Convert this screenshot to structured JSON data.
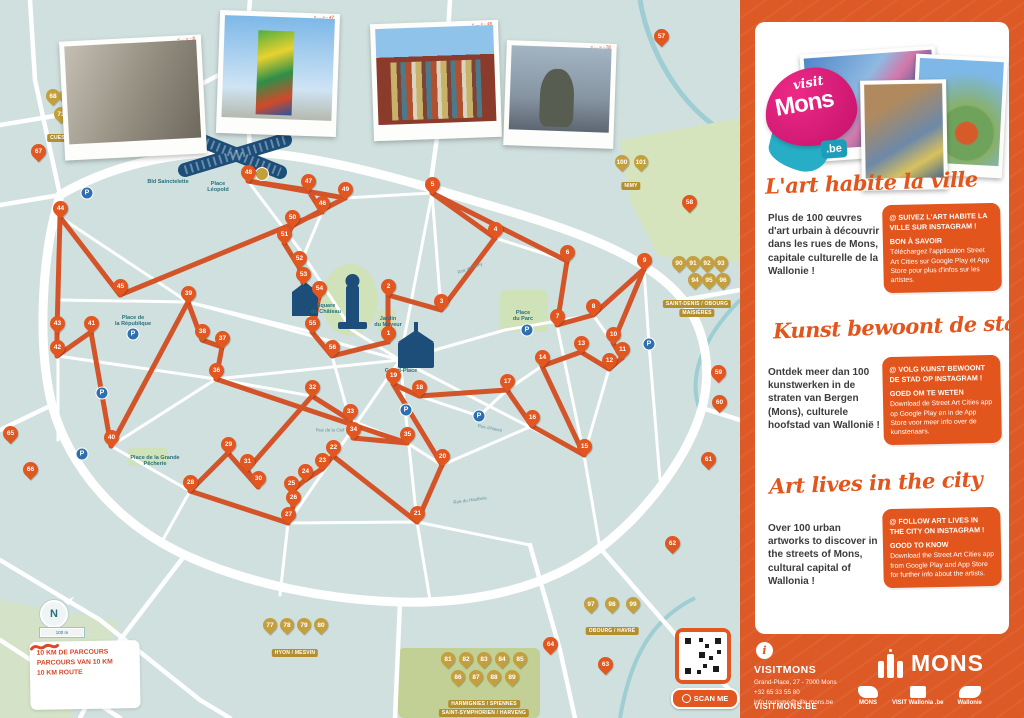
{
  "map": {
    "compass_label": "N",
    "scale_label": "100 m",
    "legend": [
      "10 KM DE PARCOURS",
      "PARCOURS VAN 10 KM",
      "10 KM ROUTE"
    ],
    "scan_label": "SCAN ME",
    "photo_captions": [
      "« ... » - 6",
      "« ... » - 47",
      "« ... » - 45",
      "« ... » - 78"
    ],
    "places": [
      {
        "t": "Place\nLéopold",
        "x": 218,
        "y": 187
      },
      {
        "t": "Bld Sainctelette",
        "x": 168,
        "y": 182
      },
      {
        "t": "Grand-Place",
        "x": 401,
        "y": 371
      },
      {
        "t": "Square\ndu Château",
        "x": 326,
        "y": 309
      },
      {
        "t": "Place\ndu Parc",
        "x": 523,
        "y": 316
      },
      {
        "t": "Place de\nla République",
        "x": 133,
        "y": 321
      },
      {
        "t": "Place de la Grande\nPêcherie",
        "x": 155,
        "y": 461
      },
      {
        "t": "Jardin\ndu Mayeur",
        "x": 388,
        "y": 322
      }
    ],
    "streets": [
      {
        "t": "Rue de Nimy",
        "x": 470,
        "y": 268,
        "r": -20
      },
      {
        "t": "Rue d'Havré",
        "x": 490,
        "y": 428,
        "r": 12
      },
      {
        "t": "Rue de la Clef",
        "x": 330,
        "y": 430,
        "r": 0
      },
      {
        "t": "Rue du Hautbois",
        "x": 470,
        "y": 500,
        "r": -8
      }
    ],
    "route_markers": [
      {
        "n": 1,
        "x": 388,
        "y": 342
      },
      {
        "n": 2,
        "x": 388,
        "y": 295
      },
      {
        "n": 3,
        "x": 441,
        "y": 310
      },
      {
        "n": 4,
        "x": 495,
        "y": 238
      },
      {
        "n": 5,
        "x": 432,
        "y": 193
      },
      {
        "n": 6,
        "x": 567,
        "y": 261
      },
      {
        "n": 7,
        "x": 557,
        "y": 325
      },
      {
        "n": 8,
        "x": 593,
        "y": 315
      },
      {
        "n": 9,
        "x": 644,
        "y": 269
      },
      {
        "n": 10,
        "x": 613,
        "y": 343
      },
      {
        "n": 11,
        "x": 622,
        "y": 358
      },
      {
        "n": 12,
        "x": 609,
        "y": 369
      },
      {
        "n": 13,
        "x": 581,
        "y": 352
      },
      {
        "n": 14,
        "x": 542,
        "y": 366
      },
      {
        "n": 15,
        "x": 584,
        "y": 455
      },
      {
        "n": 16,
        "x": 532,
        "y": 426
      },
      {
        "n": 17,
        "x": 507,
        "y": 390
      },
      {
        "n": 18,
        "x": 419,
        "y": 396
      },
      {
        "n": 19,
        "x": 393,
        "y": 384
      },
      {
        "n": 20,
        "x": 442,
        "y": 465
      },
      {
        "n": 21,
        "x": 417,
        "y": 522
      },
      {
        "n": 22,
        "x": 333,
        "y": 456
      },
      {
        "n": 23,
        "x": 322,
        "y": 469
      },
      {
        "n": 24,
        "x": 305,
        "y": 480
      },
      {
        "n": 25,
        "x": 291,
        "y": 492
      },
      {
        "n": 26,
        "x": 293,
        "y": 506
      },
      {
        "n": 27,
        "x": 288,
        "y": 523
      },
      {
        "n": 28,
        "x": 190,
        "y": 491
      },
      {
        "n": 29,
        "x": 228,
        "y": 453
      },
      {
        "n": 30,
        "x": 258,
        "y": 487
      },
      {
        "n": 31,
        "x": 247,
        "y": 470
      },
      {
        "n": 32,
        "x": 312,
        "y": 396
      },
      {
        "n": 33,
        "x": 350,
        "y": 420
      },
      {
        "n": 34,
        "x": 353,
        "y": 438
      },
      {
        "n": 35,
        "x": 407,
        "y": 443
      },
      {
        "n": 36,
        "x": 216,
        "y": 379
      },
      {
        "n": 37,
        "x": 222,
        "y": 347
      },
      {
        "n": 38,
        "x": 202,
        "y": 340
      },
      {
        "n": 39,
        "x": 188,
        "y": 302
      },
      {
        "n": 40,
        "x": 111,
        "y": 446
      },
      {
        "n": 41,
        "x": 91,
        "y": 332
      },
      {
        "n": 42,
        "x": 57,
        "y": 356
      },
      {
        "n": 43,
        "x": 57,
        "y": 332
      },
      {
        "n": 44,
        "x": 60,
        "y": 217
      },
      {
        "n": 45,
        "x": 120,
        "y": 295
      },
      {
        "n": 46,
        "x": 322,
        "y": 212
      },
      {
        "n": 47,
        "x": 308,
        "y": 190
      },
      {
        "n": 48,
        "x": 248,
        "y": 181
      },
      {
        "n": 49,
        "x": 345,
        "y": 198
      },
      {
        "n": 50,
        "x": 292,
        "y": 226
      },
      {
        "n": 51,
        "x": 284,
        "y": 243
      },
      {
        "n": 52,
        "x": 299,
        "y": 267
      },
      {
        "n": 53,
        "x": 303,
        "y": 283
      },
      {
        "n": 54,
        "x": 319,
        "y": 297
      },
      {
        "n": 55,
        "x": 312,
        "y": 332
      },
      {
        "n": 56,
        "x": 332,
        "y": 356
      }
    ],
    "extra_markers": [
      {
        "n": 57,
        "x": 661,
        "y": 45
      },
      {
        "n": 58,
        "x": 689,
        "y": 211
      },
      {
        "n": 59,
        "x": 718,
        "y": 381
      },
      {
        "n": 60,
        "x": 719,
        "y": 411
      },
      {
        "n": 61,
        "x": 708,
        "y": 468
      },
      {
        "n": 62,
        "x": 672,
        "y": 552
      },
      {
        "n": 63,
        "x": 605,
        "y": 673
      },
      {
        "n": 64,
        "x": 550,
        "y": 653
      },
      {
        "n": 65,
        "x": 10,
        "y": 442
      },
      {
        "n": 66,
        "x": 30,
        "y": 478
      },
      {
        "n": 67,
        "x": 38,
        "y": 160
      }
    ],
    "village_groups": [
      {
        "labels": [
          "CUESMES / JEMAPPES",
          "CIPLY"
        ],
        "lx": 80,
        "ly": 134,
        "markers": [
          {
            "n": 68,
            "x": 53,
            "y": 104
          },
          {
            "n": 69,
            "x": 66,
            "y": 104
          },
          {
            "n": 70,
            "x": 80,
            "y": 104
          },
          {
            "n": 71,
            "x": 94,
            "y": 104
          },
          {
            "n": 72,
            "x": 108,
            "y": 104
          },
          {
            "n": 73,
            "x": 61,
            "y": 122
          },
          {
            "n": 74,
            "x": 75,
            "y": 122
          },
          {
            "n": 75,
            "x": 89,
            "y": 122
          },
          {
            "n": 76,
            "x": 103,
            "y": 122
          }
        ]
      },
      {
        "labels": [
          "NIMY"
        ],
        "lx": 631,
        "ly": 182,
        "markers": [
          {
            "n": 100,
            "x": 622,
            "y": 170
          },
          {
            "n": 101,
            "x": 641,
            "y": 170
          }
        ]
      },
      {
        "labels": [
          "SAINT-DENIS / OBOURG",
          "MAISIÈRES"
        ],
        "lx": 697,
        "ly": 300,
        "markers": [
          {
            "n": 90,
            "x": 679,
            "y": 271
          },
          {
            "n": 91,
            "x": 693,
            "y": 271
          },
          {
            "n": 92,
            "x": 707,
            "y": 271
          },
          {
            "n": 93,
            "x": 721,
            "y": 271
          },
          {
            "n": 94,
            "x": 695,
            "y": 288
          },
          {
            "n": 95,
            "x": 709,
            "y": 288
          },
          {
            "n": 96,
            "x": 723,
            "y": 288
          }
        ]
      },
      {
        "labels": [
          "OBOURG / HAVRÉ"
        ],
        "lx": 612,
        "ly": 627,
        "markers": [
          {
            "n": 97,
            "x": 591,
            "y": 612
          },
          {
            "n": 98,
            "x": 612,
            "y": 612
          },
          {
            "n": 99,
            "x": 633,
            "y": 612
          }
        ]
      },
      {
        "labels": [
          "HARMIGNIES / SPIENNES",
          "SAINT-SYMPHORIEN / HARVENG"
        ],
        "lx": 484,
        "ly": 700,
        "markers": [
          {
            "n": 81,
            "x": 448,
            "y": 667
          },
          {
            "n": 82,
            "x": 466,
            "y": 667
          },
          {
            "n": 83,
            "x": 484,
            "y": 667
          },
          {
            "n": 84,
            "x": 502,
            "y": 667
          },
          {
            "n": 85,
            "x": 520,
            "y": 667
          },
          {
            "n": 86,
            "x": 458,
            "y": 685
          },
          {
            "n": 87,
            "x": 476,
            "y": 685
          },
          {
            "n": 88,
            "x": 494,
            "y": 685
          },
          {
            "n": 89,
            "x": 512,
            "y": 685
          }
        ]
      },
      {
        "labels": [
          "HYON / MESVIN"
        ],
        "lx": 295,
        "ly": 649,
        "markers": [
          {
            "n": 77,
            "x": 270,
            "y": 633
          },
          {
            "n": 78,
            "x": 287,
            "y": 633
          },
          {
            "n": 79,
            "x": 304,
            "y": 633
          },
          {
            "n": 80,
            "x": 321,
            "y": 633
          }
        ]
      }
    ],
    "parkings": [
      {
        "x": 87,
        "y": 193
      },
      {
        "x": 133,
        "y": 334
      },
      {
        "x": 102,
        "y": 393
      },
      {
        "x": 82,
        "y": 454
      },
      {
        "x": 527,
        "y": 330
      },
      {
        "x": 649,
        "y": 344
      },
      {
        "x": 479,
        "y": 416
      },
      {
        "x": 406,
        "y": 410
      }
    ]
  },
  "panel": {
    "logo": {
      "visit": "visit",
      "mons": "Mons",
      "be": ".be"
    },
    "sections": [
      {
        "heading": "L'art habite la ville",
        "body": "Plus de 100 œuvres d'art urbain à découvrir dans les rues de Mons, capitale culturelle de la Wallonie !",
        "follow": "@ Suivez l'art habite la ville sur Instagram !",
        "know_title": "Bon à savoir",
        "know_text": "Téléchargez l'application Street Art Cities sur Google Play et App Store pour plus d'infos sur les artistes."
      },
      {
        "heading": "Kunst bewoont de stad",
        "body": "Ontdek meer dan 100 kunstwerken in de straten van Bergen (Mons), culturele hoofstad van Wallonië !",
        "follow": "@ Volg kunst bewoont de stad op Instagram !",
        "know_title": "Goed om te weten",
        "know_text": "Download de Street Art Cities app op Google Play en in de App Store voor meer info over de kunstenaars."
      },
      {
        "heading": "Art lives in the city",
        "body": "Over 100 urban artworks to discover in the streets of Mons, cultural capital of Wallonia !",
        "follow": "@ Follow art lives in the city on Instagram !",
        "know_title": "Good to know",
        "know_text": "Download the Street Art Cities app from Google Play and App Store for further info about the artists."
      }
    ],
    "footer": {
      "brand": "VISITMONS",
      "address": "Grand-Place, 27 - 7000 Mons",
      "phone": "+32 65 33 55 80",
      "email": "info.tourisme@ville.mons.be",
      "site": "VISITMONS.BE",
      "city_logo": "MONS",
      "partners": [
        "MONS",
        "VISIT Wallonia .be",
        "Wallonie"
      ]
    }
  }
}
